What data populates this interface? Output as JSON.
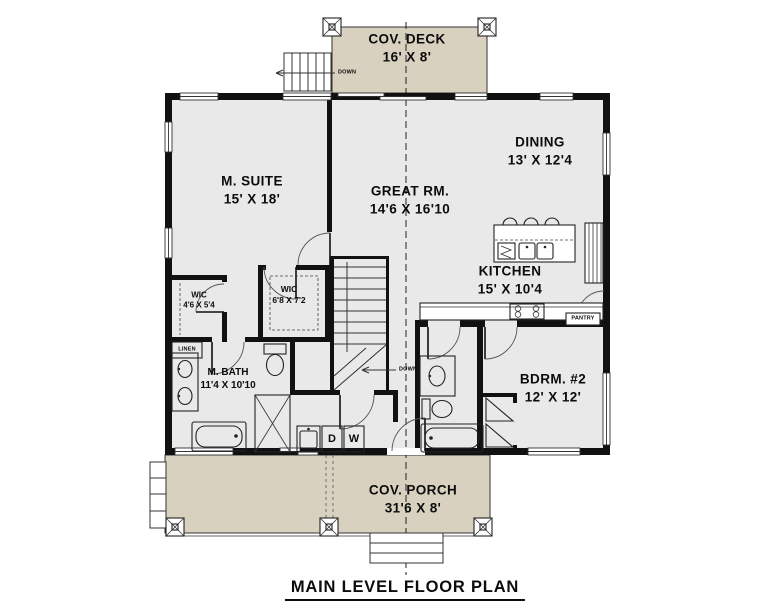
{
  "title": "MAIN LEVEL FLOOR PLAN",
  "rooms": {
    "deck": {
      "name": "COV. DECK",
      "dims": "16' X 8'"
    },
    "msuite": {
      "name": "M. SUITE",
      "dims": "15' X 18'"
    },
    "great": {
      "name": "GREAT RM.",
      "dims": "14'6 X 16'10"
    },
    "dining": {
      "name": "DINING",
      "dims": "13' X 12'4"
    },
    "kitchen": {
      "name": "KITCHEN",
      "dims": "15' X 10'4"
    },
    "wic_small": {
      "name": "WIC",
      "dims": "4'6 X 5'4"
    },
    "wic_large": {
      "name": "WIC",
      "dims": "6'8 X 7'2"
    },
    "mbath": {
      "name": "M. BATH",
      "dims": "11'4 X 10'10"
    },
    "bdrm2": {
      "name": "BDRM. #2",
      "dims": "12' X 12'"
    },
    "porch": {
      "name": "COV. PORCH",
      "dims": "31'6 X 8'"
    }
  },
  "labels": {
    "pantry": "PANTRY",
    "linen": "LINEN",
    "down_deck": "DOWN",
    "down_stairs": "DOWN",
    "dryer": "D",
    "washer": "W"
  },
  "colors": {
    "wall": "#111111",
    "floor": "#e9e9e9",
    "deck": "#d9d1c0",
    "bg": "#ffffff"
  }
}
